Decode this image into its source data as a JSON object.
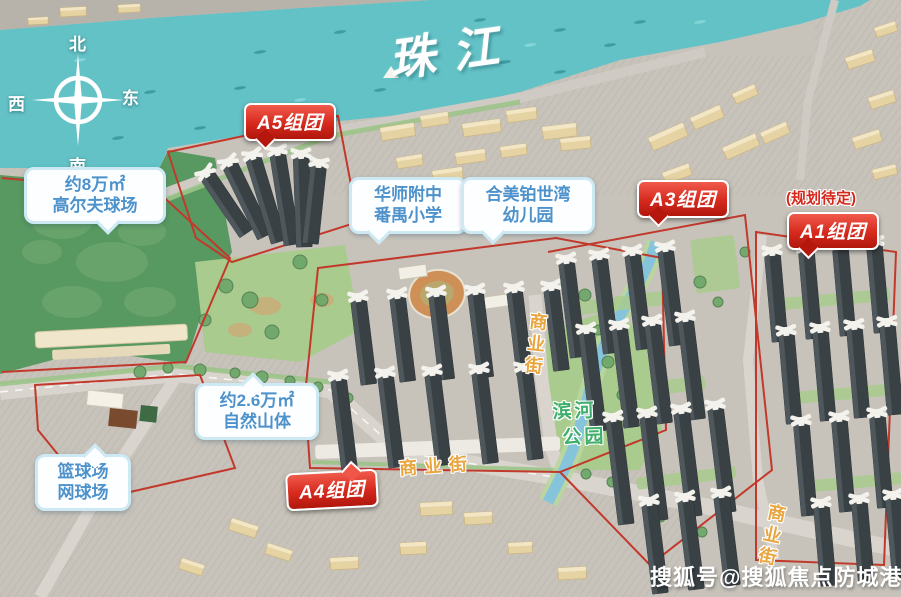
{
  "map": {
    "river": {
      "label": "珠江"
    },
    "compass": {
      "north": "北",
      "south": "南",
      "west": "西",
      "east": "东"
    },
    "badges": {
      "a5": "A5组团",
      "a3": "A3组团",
      "a1": "A1组团",
      "a4": "A4组团",
      "a1_note": "(规划待定)"
    },
    "bubbles": {
      "golf": {
        "line1": "约8万㎡",
        "line2": "高尔夫球场"
      },
      "school": {
        "line1": "华师附中",
        "line2": "番禺小学"
      },
      "kindergarten": {
        "line1": "合美铂世湾",
        "line2": "幼儿园"
      },
      "mountain": {
        "line1": "约2.6万㎡",
        "line2": "自然山体"
      },
      "courts": {
        "line1": "篮球场",
        "line2": "网球场"
      }
    },
    "streets": {
      "central": "商业街",
      "south": "商业街",
      "east": "商业街"
    },
    "park": {
      "line1": "滨河",
      "line2": "公园"
    },
    "watermark": "搜狐号@搜狐焦点防城港站",
    "colors": {
      "water": "#63c2c6",
      "golf": "#589961",
      "park": "#a9cb8d",
      "badge_red": "#cd2318",
      "bubble_blue": "#4e92cc",
      "street_orange": "#e9a53f",
      "park_text": "#3fae6a",
      "boundary": "#c2392c"
    }
  }
}
